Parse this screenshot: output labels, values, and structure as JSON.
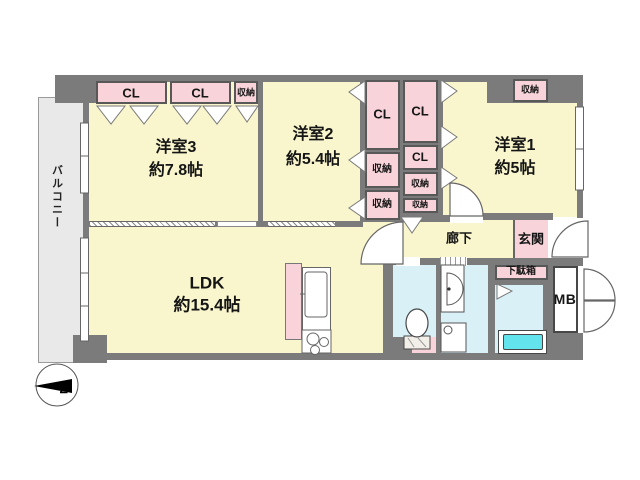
{
  "colors": {
    "canvas": "#ffffff",
    "wall": "#7b7b7b",
    "room": "#f9f6cd",
    "closet": "#f8d4da",
    "wet": "#d8f0f6",
    "tub": "#63e3ec",
    "balcony": "#e9e9e9"
  },
  "compass": {
    "north_label": "N"
  },
  "balcony": {
    "label": "バルコニー"
  },
  "rooms": {
    "western3": {
      "name": "洋室3",
      "size": "約7.8帖"
    },
    "western2": {
      "name": "洋室2",
      "size": "約5.4帖"
    },
    "western1": {
      "name": "洋室1",
      "size": "約5帖"
    },
    "ldk": {
      "name": "LDK",
      "size": "約15.4帖"
    },
    "hallway": {
      "name": "廊下"
    },
    "entrance": {
      "name": "玄関"
    },
    "shoe_cabinet": {
      "name": "下駄箱"
    },
    "meter_box": {
      "name": "MB"
    }
  },
  "closets": {
    "top_row": [
      "CL",
      "CL",
      "収納"
    ],
    "mid_left_column": [
      "CL",
      "収納",
      "収納"
    ],
    "mid_right_column": [
      "CL",
      "CL",
      "収納",
      "収納"
    ],
    "western1_storage": "収納"
  }
}
